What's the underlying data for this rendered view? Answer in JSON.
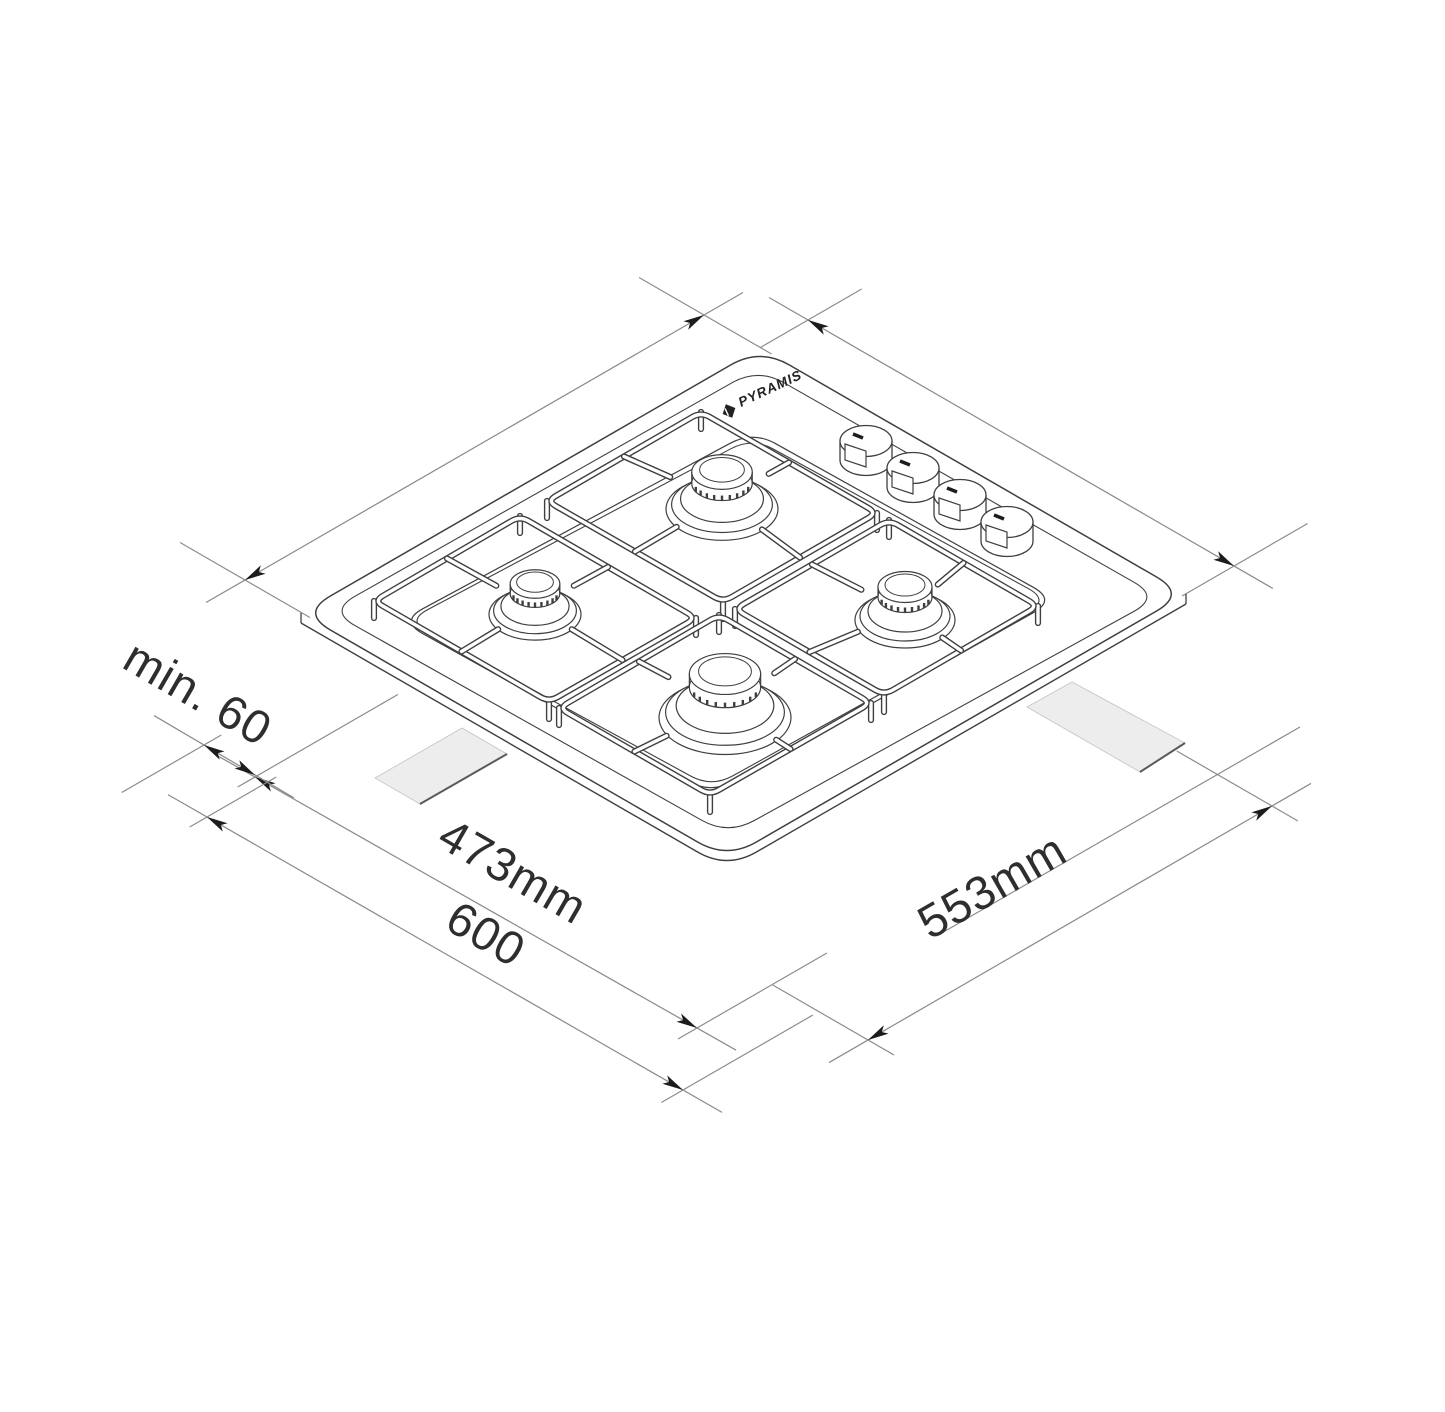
{
  "figure": {
    "subject": "gas-hob-4-burner-isometric-installation-drawing",
    "burner_count": 4,
    "knob_count": 4
  },
  "brand": {
    "logo_text": "PYRAMIS"
  },
  "dimensions": {
    "front_clearance": {
      "label": "min. 60"
    },
    "cutout_front": {
      "label": "473mm"
    },
    "overall_front": {
      "label": "600"
    },
    "cutout_side": {
      "label": "553mm"
    }
  },
  "colors": {
    "drawing_line": "#3f3f3f",
    "dimension_line": "#8c8c8c",
    "arrow": "#1c1c1c",
    "label_text": "#2e2e2e",
    "cutout_fill": "#ededed",
    "cutout_edge": "#5a5a5a",
    "background": "#ffffff"
  }
}
